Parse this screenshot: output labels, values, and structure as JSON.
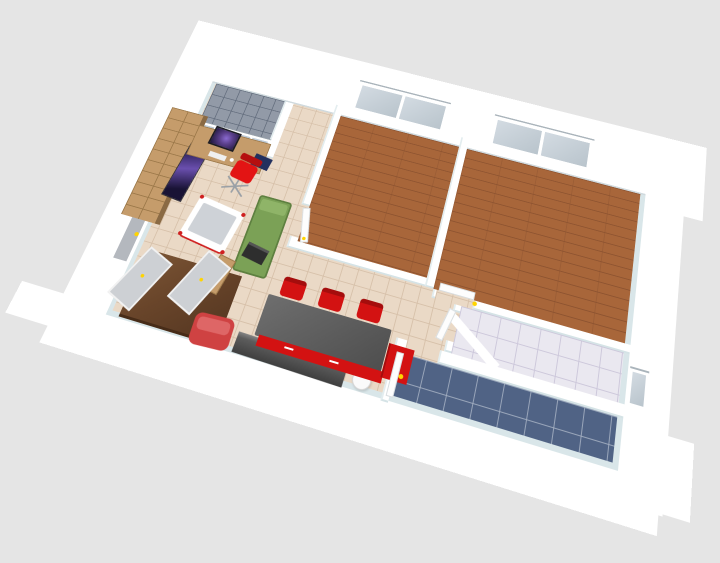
{
  "app": {
    "name": "3d-floor-plan-render",
    "view": "aerial-perspective-view"
  },
  "canvas": {
    "width": 720,
    "height": 563,
    "background": "#e5e5e5"
  },
  "colors": {
    "background": "#e5e5e5",
    "wall_white": "#ffffff",
    "wall_inner_shade": "#d9e6e9",
    "beige_tile": "#ead9c6",
    "tile_grout": "#d7c1aa",
    "wood_floor": "#a8663a",
    "balcony_tile": "#929aa7",
    "marble_floor": "#eae8f0",
    "blue_tile": "#506385",
    "window_pane": "#c3ced8",
    "door_gray": "#b4b8be",
    "handle_yellow": "#ffd400",
    "oak_wood": "#c59c6b",
    "dark_wardrobe": "#69452a",
    "kitchen_red": "#d31212",
    "chair_red": "#e31414",
    "armchair_red": "#cf4242",
    "counter_gray": "#5a5a5a",
    "sideboard_gray": "#3f3f3f",
    "sofa_green": "#7ba156",
    "screen_galaxy_purple": "#5a3f8a",
    "bin_white": "#fafafa"
  },
  "rooms": [
    {
      "name": "living-room",
      "floor": "beige-tile"
    },
    {
      "name": "balcony",
      "floor": "gray-tile",
      "feature": "glass-french-doors"
    },
    {
      "name": "bedroom-1",
      "floor": "wood-parquet",
      "feature": "window"
    },
    {
      "name": "bedroom-2",
      "floor": "wood-parquet",
      "feature": "window"
    },
    {
      "name": "corridor",
      "floor": "beige-tile"
    },
    {
      "name": "bathroom",
      "floor": "marble-tile",
      "feature": "small-window"
    },
    {
      "name": "bathroom-2",
      "floor": "blue-tile"
    },
    {
      "name": "entrance-hall",
      "floor": "beige-tile",
      "feature": "entrance-door"
    },
    {
      "name": "kitchen-dining",
      "floor": "beige-tile"
    }
  ],
  "furniture": [
    "bookshelf",
    "tv-panel",
    "desk",
    "monitor",
    "keyboard",
    "office-chair",
    "baby-crib",
    "green-daybed",
    "laptop",
    "wardrobe",
    "wardrobe-doors",
    "red-armchair",
    "gray-sideboard",
    "round-bin",
    "dining-counter",
    "red-cabinet-front",
    "red-cabinet",
    "dining-chairs"
  ],
  "openings": {
    "bedroom_windows": 2,
    "bathroom_window": 1,
    "balcony_glass_panels": 4,
    "interior_doors": 4,
    "entrance_door": 1
  }
}
